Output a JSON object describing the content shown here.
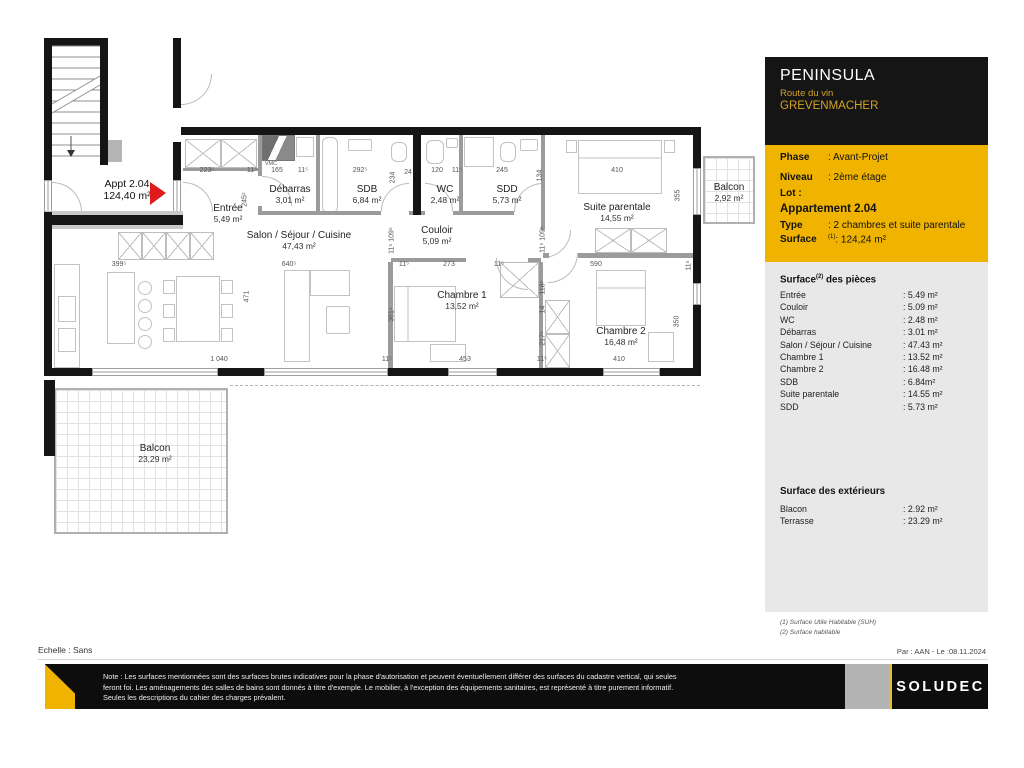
{
  "title_block": {
    "project": "PENINSULA",
    "street": "Route du vin",
    "city": "GREVENMACHER",
    "info_rows": [
      {
        "label": "Phase",
        "sup": "",
        "value": ": Avant-Projet",
        "cls": "",
        "top": 7
      },
      {
        "label": "Niveau",
        "sup": "",
        "value": ": 2ème étage",
        "cls": "",
        "top": 27
      },
      {
        "label": "Lot :",
        "sup": "",
        "value": "",
        "cls": "",
        "top": 43
      },
      {
        "label": "Appartement 2.04",
        "sup": "",
        "value": "",
        "cls": "apt",
        "top": 58
      },
      {
        "label": "Type",
        "sup": "",
        "value": ": 2 chambres et suite parentale",
        "cls": "",
        "top": 75
      },
      {
        "label": "Surface",
        "sup": "(1)",
        "value": ": 124,24 m²",
        "cls": "",
        "top": 89
      }
    ],
    "rooms_heading": {
      "pre": "Surface",
      "sup": "(2)",
      "post": " des pièces"
    },
    "rooms": [
      {
        "name": "Entrée",
        "value": ": 5.49 m²"
      },
      {
        "name": "Couloir",
        "value": ": 5.09 m²"
      },
      {
        "name": "WC",
        "value": ": 2.48 m²"
      },
      {
        "name": "Débarras",
        "value": ": 3.01 m²"
      },
      {
        "name": "Salon / Séjour / Cuisine",
        "value": ": 47.43 m²"
      },
      {
        "name": "Chambre 1",
        "value": ": 13.52 m²"
      },
      {
        "name": "Chambre 2",
        "value": ": 16.48 m²"
      },
      {
        "name": "SDB",
        "value": ": 6.84m²"
      },
      {
        "name": "Suite parentale",
        "value": ": 14.55 m²"
      },
      {
        "name": "SDD",
        "value": ": 5.73 m²"
      }
    ],
    "ext_heading": "Surface des extérieurs",
    "exteriors": [
      {
        "name": "Blacon",
        "value": ": 2.92 m²"
      },
      {
        "name": "Terrasse",
        "value": ": 23.29 m²"
      }
    ],
    "footnotes": [
      "(1) Surface Utile Habitable (SUH)",
      "(2) Surface habitable"
    ]
  },
  "meta": {
    "echelle": "Echelle : Sans",
    "par_date": "Par : AAN - Le :08.11.2024",
    "note": "Note : Les surfaces mentionnées sont des surfaces brutes indicatives pour la phase d'autorisation et peuvent éventuellement différer des surfaces du cadastre vertical, qui seules feront foi. Les aménagements des salles de bains sont donnés à titre d'exemple. Le mobilier, à l'exception des équipements sanitaires, est représenté à titre purement informatif. Seules les descriptions du cahier des charges prévalent.",
    "logo_text": "SOLUDEC"
  },
  "colors": {
    "accent_gold": "#f0b400",
    "header_black": "#151515",
    "panel_gray": "#e8e8e8",
    "arrow_red": "#e01b1b"
  },
  "plan": {
    "appt_label": {
      "x": 127,
      "y": 179,
      "line1": "Appt 2.04",
      "line2": "124,40 m²"
    },
    "rooms": [
      [
        228,
        203,
        "Entrée",
        "5,49 m²"
      ],
      [
        290,
        184,
        "Débarras",
        "3,01 m²"
      ],
      [
        367,
        184,
        "SDB",
        "6,84 m²"
      ],
      [
        445,
        184,
        "WC",
        "2,48 m²"
      ],
      [
        507,
        184,
        "SDD",
        "5,73 m²"
      ],
      [
        617,
        202,
        "Suite parentale",
        "14,55 m²"
      ],
      [
        729,
        182,
        "Balcon",
        "2,92 m²"
      ],
      [
        299,
        230,
        "Salon / Séjour / Cuisine",
        "47,43 m²"
      ],
      [
        437,
        225,
        "Couloir",
        "5,09 m²"
      ],
      [
        462,
        290,
        "Chambre 1",
        "13,52 m²"
      ],
      [
        621,
        326,
        "Chambre 2",
        "16,48 m²"
      ],
      [
        155,
        443,
        "Balcon",
        "23,29 m²"
      ]
    ],
    "dims": [
      [
        207,
        167,
        "223⁵",
        0
      ],
      [
        252,
        167,
        "11⁵",
        0
      ],
      [
        277,
        167,
        "165",
        0
      ],
      [
        303,
        167,
        "11⁵",
        0
      ],
      [
        360,
        167,
        "292⁵",
        0
      ],
      [
        408,
        169,
        "24",
        0
      ],
      [
        437,
        167,
        "120",
        0
      ],
      [
        457,
        167,
        "11⁵",
        0
      ],
      [
        502,
        167,
        "245",
        0
      ],
      [
        617,
        167,
        "410",
        0
      ],
      [
        271,
        161,
        "VMC",
        0
      ],
      [
        245,
        196,
        "245⁵",
        1
      ],
      [
        393,
        174,
        "234",
        1
      ],
      [
        540,
        172,
        "134",
        1
      ],
      [
        678,
        192,
        "355",
        1
      ],
      [
        247,
        293,
        "471",
        1
      ],
      [
        392,
        237,
        "11⁵ 109⁵",
        1
      ],
      [
        543,
        236,
        "11⁵ 109⁵",
        1
      ],
      [
        392,
        311,
        "361⁵",
        1
      ],
      [
        543,
        284,
        "118⁵",
        1
      ],
      [
        543,
        306,
        "14",
        1
      ],
      [
        543,
        335,
        "217⁵",
        1
      ],
      [
        677,
        318,
        "350",
        1
      ],
      [
        689,
        262,
        "11⁵",
        1
      ],
      [
        119,
        261,
        "399⁵",
        0
      ],
      [
        289,
        261,
        "640⁵",
        0
      ],
      [
        404,
        261,
        "11⁵",
        0
      ],
      [
        449,
        261,
        "273",
        0
      ],
      [
        499,
        261,
        "11⁵",
        0
      ],
      [
        596,
        261,
        "590",
        0
      ],
      [
        219,
        356,
        "1 040",
        0
      ],
      [
        387,
        356,
        "11⁵",
        0
      ],
      [
        465,
        356,
        "453",
        0
      ],
      [
        542,
        356,
        "11⁵",
        0
      ],
      [
        619,
        356,
        "410",
        0
      ]
    ],
    "walls_black": [
      [
        44,
        38,
        64,
        8
      ],
      [
        44,
        38,
        8,
        142
      ],
      [
        44,
        212,
        8,
        164
      ],
      [
        100,
        38,
        8,
        127
      ],
      [
        173,
        38,
        8,
        70
      ],
      [
        173,
        142,
        8,
        38
      ],
      [
        181,
        127,
        520,
        8
      ],
      [
        693,
        127,
        8,
        41
      ],
      [
        693,
        215,
        8,
        68
      ],
      [
        693,
        305,
        8,
        71
      ],
      [
        52,
        368,
        40,
        8
      ],
      [
        218,
        368,
        46,
        8
      ],
      [
        388,
        368,
        60,
        8
      ],
      [
        497,
        368,
        106,
        8
      ],
      [
        660,
        368,
        41,
        8
      ],
      [
        44,
        380,
        11,
        76
      ],
      [
        413,
        130,
        8,
        85
      ]
    ],
    "hall_wall": [
      46,
      215,
      137,
      10
    ],
    "walls_gray": [
      [
        258,
        135,
        4,
        41
      ],
      [
        258,
        206,
        4,
        9
      ],
      [
        262,
        211,
        54,
        4
      ],
      [
        316,
        135,
        4,
        80
      ],
      [
        320,
        211,
        61,
        4
      ],
      [
        409,
        211,
        4,
        4
      ],
      [
        421,
        211,
        4,
        4
      ],
      [
        453,
        211,
        10,
        4
      ],
      [
        459,
        135,
        4,
        76
      ],
      [
        463,
        211,
        51,
        4
      ],
      [
        541,
        135,
        4,
        95
      ],
      [
        391,
        258,
        75,
        4
      ],
      [
        528,
        258,
        13,
        4
      ],
      [
        388,
        262,
        5,
        106
      ],
      [
        539,
        262,
        4,
        106
      ],
      [
        543,
        253,
        6,
        5
      ],
      [
        578,
        253,
        117,
        5
      ],
      [
        183,
        168,
        75,
        3
      ]
    ],
    "windows": [
      [
        44,
        180,
        8,
        32
      ],
      [
        173,
        180,
        8,
        32
      ],
      [
        92,
        368,
        126,
        8
      ],
      [
        264,
        368,
        124,
        8
      ],
      [
        448,
        368,
        49,
        8
      ],
      [
        603,
        368,
        57,
        8
      ],
      [
        693,
        168,
        8,
        47
      ],
      [
        693,
        283,
        8,
        22
      ]
    ],
    "balconies": [
      {
        "x": 54,
        "y": 388,
        "w": 174,
        "h": 146
      },
      {
        "x": 703,
        "y": 156,
        "w": 52,
        "h": 68
      }
    ],
    "dashed_lines": [
      [
        230,
        385,
        470
      ]
    ],
    "furniture": [
      [
        54,
        264,
        26,
        104,
        0
      ],
      [
        58,
        296,
        18,
        26,
        0
      ],
      [
        58,
        328,
        18,
        24,
        0
      ],
      [
        107,
        272,
        28,
        72,
        0
      ],
      [
        176,
        276,
        44,
        66,
        0
      ],
      [
        163,
        280,
        12,
        14,
        0
      ],
      [
        163,
        304,
        12,
        14,
        0
      ],
      [
        163,
        328,
        12,
        14,
        0
      ],
      [
        221,
        280,
        12,
        14,
        0
      ],
      [
        221,
        304,
        12,
        14,
        0
      ],
      [
        221,
        328,
        12,
        14,
        0
      ],
      [
        284,
        270,
        26,
        92,
        0
      ],
      [
        310,
        270,
        40,
        26,
        0
      ],
      [
        326,
        306,
        24,
        28,
        2
      ],
      [
        322,
        137,
        16,
        76,
        6
      ],
      [
        348,
        139,
        24,
        12,
        2
      ],
      [
        391,
        142,
        16,
        20,
        6
      ],
      [
        426,
        140,
        18,
        24,
        6
      ],
      [
        446,
        138,
        12,
        10,
        2
      ],
      [
        464,
        137,
        30,
        30,
        0
      ],
      [
        500,
        142,
        16,
        20,
        6
      ],
      [
        520,
        139,
        18,
        12,
        2
      ],
      [
        296,
        137,
        18,
        20,
        0
      ],
      [
        578,
        140,
        84,
        54,
        0
      ],
      [
        566,
        140,
        11,
        13,
        0
      ],
      [
        664,
        140,
        11,
        13,
        0
      ],
      [
        596,
        270,
        50,
        56,
        0
      ],
      [
        648,
        332,
        26,
        30,
        0
      ],
      [
        394,
        286,
        62,
        56,
        0
      ],
      [
        430,
        344,
        36,
        18,
        0
      ]
    ],
    "circles": [
      [
        145,
        288,
        7
      ],
      [
        145,
        306,
        7
      ],
      [
        145,
        324,
        7
      ],
      [
        145,
        342,
        7
      ]
    ],
    "xboxes": [
      [
        185,
        139,
        36,
        29
      ],
      [
        221,
        139,
        36,
        29
      ],
      [
        118,
        232,
        24,
        28
      ],
      [
        142,
        232,
        24,
        28
      ],
      [
        166,
        232,
        24,
        28
      ],
      [
        190,
        232,
        24,
        28
      ],
      [
        595,
        228,
        36,
        25
      ],
      [
        631,
        228,
        36,
        25
      ],
      [
        545,
        300,
        25,
        34
      ],
      [
        545,
        334,
        25,
        34
      ],
      [
        500,
        262,
        39,
        36
      ]
    ],
    "vmc_box": [
      262,
      135,
      33,
      26
    ],
    "gray_boxes": [
      [
        108,
        140,
        14,
        22
      ]
    ],
    "doors": [
      [
        183,
        182,
        30,
        "tr"
      ],
      [
        52,
        182,
        30,
        "tr"
      ],
      [
        181,
        74,
        31,
        "br"
      ],
      [
        262,
        176,
        30,
        "tr"
      ],
      [
        381,
        183,
        28,
        "tl"
      ],
      [
        425,
        183,
        28,
        "tr"
      ],
      [
        514,
        183,
        29,
        "tl"
      ],
      [
        543,
        230,
        28,
        "br"
      ],
      [
        496,
        258,
        32,
        "bl"
      ],
      [
        548,
        253,
        30,
        "br"
      ]
    ],
    "lines": [
      [
        578,
        158,
        662,
        158
      ],
      [
        596,
        288,
        646,
        288
      ],
      [
        408,
        286,
        408,
        342
      ]
    ],
    "stairs": {
      "x": 52,
      "y": 46,
      "x2": 100,
      "treads": 11,
      "step": 11,
      "brk": [
        52,
        104,
        100,
        76
      ],
      "arrow": [
        71,
        150
      ]
    },
    "red_arrow": [
      [
        150,
        182
      ],
      [
        166,
        193
      ],
      [
        150,
        205
      ]
    ],
    "compass": {
      "cx": 803,
      "cy": 588,
      "r": 23,
      "mark": "Z",
      "mark_x": 833,
      "mark_y": 572
    }
  }
}
